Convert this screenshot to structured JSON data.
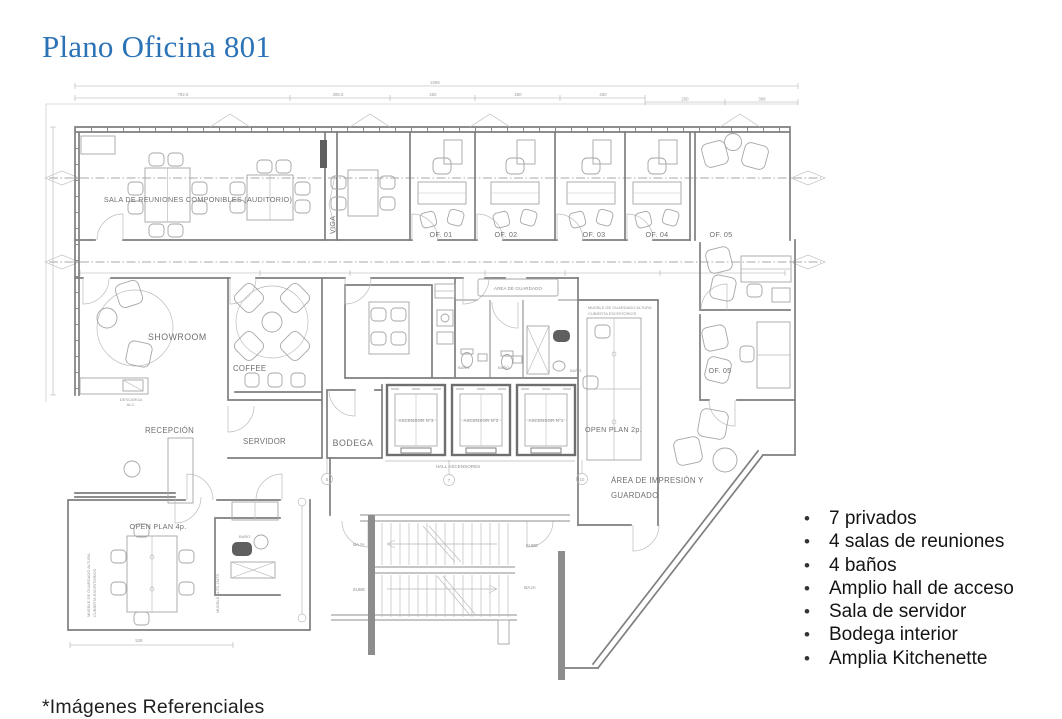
{
  "title": "Plano Oficina 801",
  "footnote": "*Imágenes Referenciales",
  "bullets": [
    "7 privados",
    "4 salas de reuniones",
    "4 baños",
    "Amplio hall de acceso",
    "Sala de servidor",
    "Bodega interior",
    "Amplia Kitchenette"
  ],
  "colors": {
    "title_blue": "#2b73b6",
    "plan_line": "#8c8c8c",
    "plan_text": "#6f6f6f",
    "body_text": "#141414"
  },
  "plan": {
    "rooms": {
      "sala": "SALA DE REUNIONES COMPONIBLES (AUDITORIO)",
      "viga": "VIGA",
      "showroom": "SHOWROOM",
      "coffee": "COFFEE",
      "recepcion": "RECEPCIÓN",
      "servidor": "SERVIDOR",
      "bodega": "BODEGA",
      "hall": "HALL ASCENSORES",
      "guardado": "AREA DE GUARDADO",
      "open2": "OPEN PLAN 2p.",
      "open4": "OPEN PLAN 4p.",
      "imp1": "ÁREA DE IMPRESIÓN Y",
      "imp2": "GUARDADO",
      "bano": "BAÑO",
      "descarga": "DESCARGA",
      "alc": "ALC.",
      "mueble1": "MUEBLE DE GUARDADO ALTURA",
      "mueble2": "CUBIERTA ESCRITORIOS",
      "mueble_alto": "MUEBLE ALTO 2MTS"
    },
    "offices": [
      "OF. 01",
      "OF. 02",
      "OF. 03",
      "OF. 04",
      "OF. 05",
      "OF. 05"
    ],
    "elevators": [
      "ASCENSOR N°3",
      "ASCENSOR N°2",
      "ASCENSOR N°1"
    ],
    "stairs": {
      "sube": "SUBE",
      "baja": "BAJA"
    },
    "bubbles": [
      "5",
      "7",
      "10"
    ],
    "dims": {
      "total": "2266",
      "segs": [
        "782.5",
        "285.5",
        "250",
        "250",
        "250",
        "250",
        "308"
      ],
      "bottom": "538"
    }
  }
}
